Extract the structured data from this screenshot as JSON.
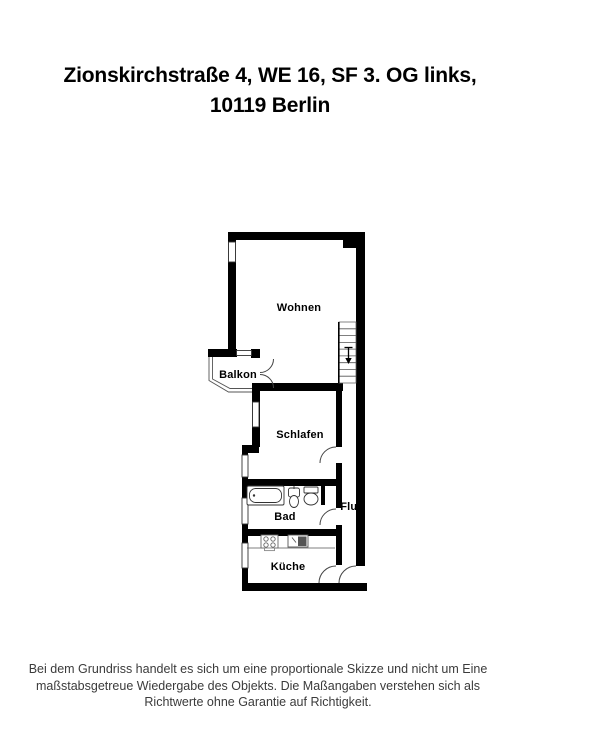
{
  "title": {
    "line1": "Zionskirchstraße 4, WE 16, SF 3. OG links,",
    "line2": "10119 Berlin"
  },
  "rooms": {
    "wohnen": "Wohnen",
    "balkon": "Balkon",
    "schlafen": "Schlafen",
    "bad": "Bad",
    "flur": "Flur",
    "kueche": "Küche"
  },
  "stairs": {
    "direction_icon": "down-arrow"
  },
  "footer": {
    "line1": "Bei dem Grundriss handelt es sich um eine proportionale Skizze und nicht um Eine",
    "line2": "maßstabsgetreue Wiedergabe des Objekts. Die Maßangaben verstehen sich als",
    "line3": "Richtwerte ohne Garantie auf Richtigkeit."
  },
  "colors": {
    "wall": "#000000",
    "thin_line": "#444444",
    "title_text": "#000000",
    "footer_text": "#3b3b3b",
    "background": "#ffffff"
  }
}
